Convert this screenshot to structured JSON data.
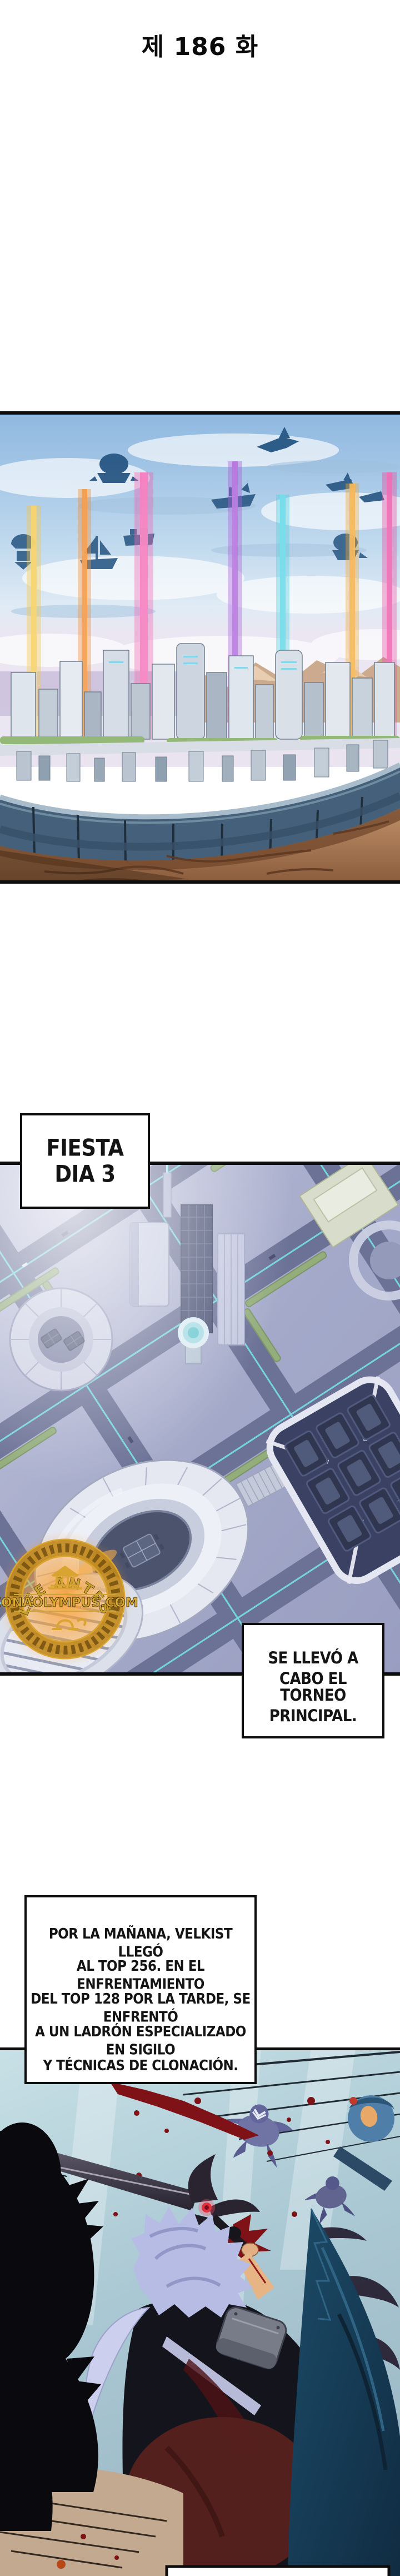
{
  "page": {
    "title": "제 186 화",
    "background": "#ffffff"
  },
  "captions": {
    "fiesta": {
      "line1": "FIESTA",
      "line2": "DIA 3"
    },
    "torneo": {
      "line1": "SE LLEVÓ A CABO EL",
      "line2": "TORNEO PRINCIPAL."
    },
    "velkist": {
      "line1": "POR LA MAÑANA, VELKIST LLEGÓ",
      "line2": "AL TOP 256. EN EL ENFRENTAMIENTO",
      "line3": "DEL TOP 128 POR LA TARDE, SE ENFRENTÓ",
      "line4": "A UN LADRÓN ESPECIALIZADO EN SIGILO",
      "line5": "Y TÉCNICAS DE CLONACIÓN."
    }
  },
  "watermark": {
    "arc_text": "LEE ANTES",
    "site_text": "ZONAOLYMPUS.COM",
    "icon": "greek-temple-icon",
    "gold": "#d9a430",
    "glow": "#ff9d2e"
  },
  "art": {
    "panel1_alt": "futuristic circular walled city with colored light beams and airships in a blue sky, rocky ground in front",
    "panel2_alt": "hazy isometric aerial view of a futuristic city district with ring buildings, glowing roads, an oval stadium and a square arena",
    "panel3_alt": "battle scene: lavender-haired fighter swinging a demonic greatsword with a red eye, blood spray, purple-robed enemies knocked back",
    "beam_colors": [
      "#f2c33e",
      "#f08a2e",
      "#ee5fae",
      "#a85ad6",
      "#49ccdc",
      "#f0a433",
      "#e84a9e"
    ],
    "panel_border": "#0d0d0d",
    "blood_color": "#7e1216",
    "sword_eye_color": "#e23040"
  }
}
